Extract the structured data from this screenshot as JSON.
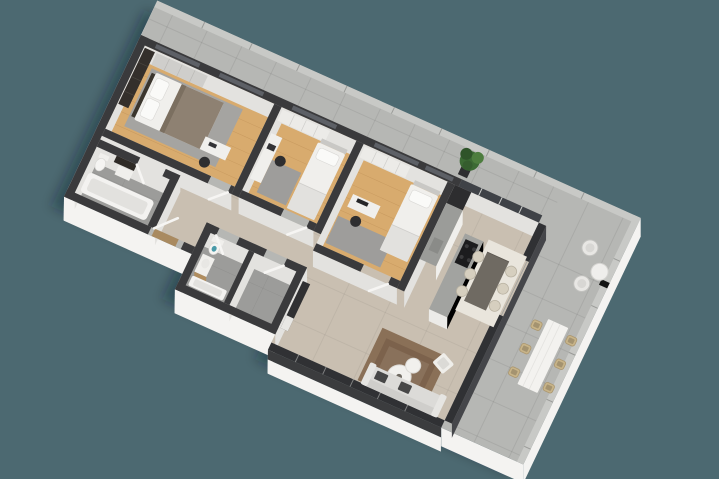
{
  "scene": {
    "description": "Isometric 3D architectural render of an apartment floor plan: three bedrooms, two bathrooms, hallway, open-plan kitchen / dining / living area, and an L-shaped concrete terrace with outdoor furniture",
    "projection": "isometric-top-down",
    "visible_text": "none"
  },
  "palette": {
    "background": "#4C6971",
    "terrace_concrete": "#B6B7B4",
    "coping": "#C8C9C6",
    "exterior_face": "#F4F3F1",
    "wall_dark": "#3A3A3C",
    "interior_face": "#E3E2DF",
    "wood_floor": "#D8AB6E",
    "living_floor": "#C9BFB1",
    "bath_floor": "#9C9C9A",
    "rug_grey": "#A5A4A1",
    "rug_brown": "#8A7057",
    "glass_dark": "#303134",
    "bed_white": "#F0EFEC",
    "blanket_taupe": "#8E8172",
    "island_grey": "#A2A3A0",
    "cooktop_black": "#1C1C1E",
    "dining_table": "#6F6A62",
    "chair_cream": "#D6CFBF",
    "wicker_tan": "#C8B489",
    "plant_green": "#3C6A34",
    "toilet_water": "#4A9AA8",
    "vanity_wood": "#B08D5F",
    "doormat_tan": "#A98A60",
    "dining_rug": "#E9E5DC",
    "sofa_grey": "#DCDBD8"
  },
  "rooms": [
    {
      "name": "master-bedroom",
      "floor": "oak-wood",
      "furniture": [
        "double-bed",
        "pillows",
        "taupe-throw-blanket",
        "dark-wardrobe",
        "grey-wardrobe",
        "grey-area-rug",
        "desk",
        "desk-chair"
      ]
    },
    {
      "name": "bedroom-2",
      "floor": "oak-wood",
      "furniture": [
        "single-bed",
        "wardrobe",
        "desk",
        "desk-chair",
        "grey-area-rug"
      ]
    },
    {
      "name": "bedroom-3",
      "floor": "oak-wood",
      "furniture": [
        "single-bed",
        "desk",
        "monitor",
        "desk-chair",
        "grey-area-rug",
        "wardrobe"
      ]
    },
    {
      "name": "bathroom-1",
      "floor": "grey-tile",
      "furniture": [
        "bathtub",
        "toilet",
        "vanity",
        "dark-cabinet"
      ]
    },
    {
      "name": "bathroom-2",
      "floor": "grey-tile",
      "furniture": [
        "toilet",
        "vanity-with-wood-base",
        "bathtub"
      ]
    },
    {
      "name": "hallway",
      "floor": "beige-tile",
      "furniture": [
        "open-entry-door",
        "doormat"
      ]
    },
    {
      "name": "kitchen",
      "floor": "beige-tile",
      "furniture": [
        "tall-dark-cabinet",
        "counter-run",
        "island-with-cooktop"
      ]
    },
    {
      "name": "dining-area",
      "floor": "beige-tile",
      "furniture": [
        "dark-dining-table",
        "six-cream-chairs",
        "white-rug"
      ]
    },
    {
      "name": "living-room",
      "floor": "beige-tile",
      "furniture": [
        "sofa-with-dark-cushions",
        "two-round-coffee-tables",
        "lounge-chair",
        "brown-rug",
        "tv-console"
      ]
    },
    {
      "name": "terrace",
      "floor": "concrete-tile",
      "furniture": [
        "two-wire-chairs",
        "round-side-table",
        "outdoor-dining-table",
        "six-wicker-chairs",
        "potted-plant"
      ]
    }
  ]
}
